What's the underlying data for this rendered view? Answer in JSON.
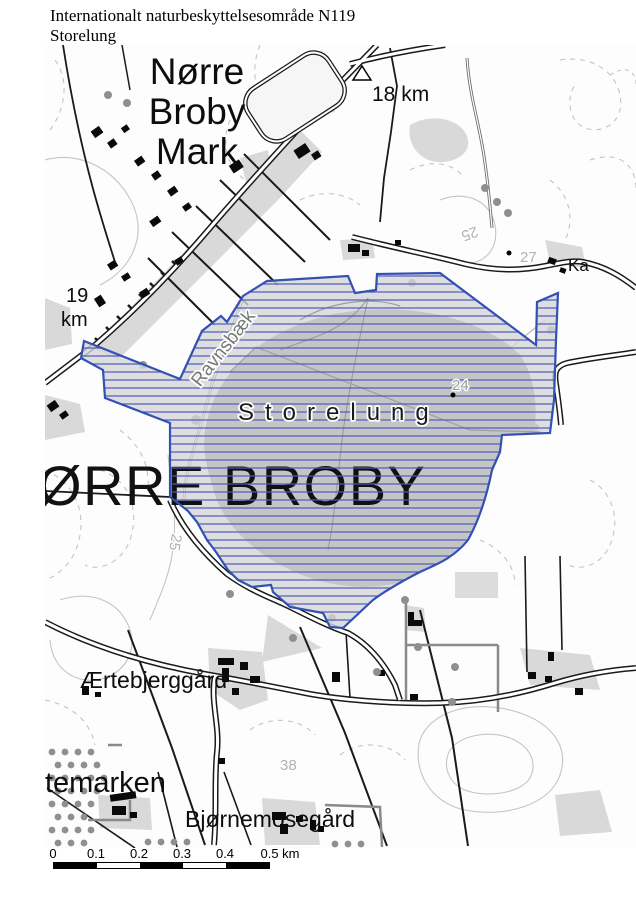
{
  "title": {
    "line1": "Internationalt naturbeskyttelsesområde N119",
    "line2": "Storelung"
  },
  "map": {
    "place_labels": {
      "norre_1": "Nørre",
      "norre_2": "Broby",
      "norre_3": "Mark",
      "town": "ØRRE BROBY",
      "area": "Storelung",
      "stream": "Ravnsbæk",
      "farm_aertebjerggaard": "Ærtebjerggård",
      "farm_bjoernemosegaard": "Bjørnemosegård",
      "field_temarken": "temarken",
      "road_right_clipped": "Ka"
    },
    "distance_labels": {
      "d18": "18 km",
      "d19_line1": "19",
      "d19_line2": "km"
    },
    "contour_labels": {
      "c24": "24",
      "c25_east": "25",
      "c25_west": "25",
      "c27": "27",
      "c38": "38"
    },
    "colors": {
      "protected_area_border": "#3350b5",
      "protected_area_hatch": "#4a5cb0",
      "bog_fill": "#d6d6d8",
      "bog_core": "#c5c5c8",
      "landuse_gray": "#d9d9d9",
      "contour_gray": "#c4c4c4",
      "building_black": "#0a0a0a",
      "dot_gray": "#8f8f8f"
    }
  },
  "scalebar": {
    "ticks": [
      "0",
      "0.1",
      "0.2",
      "0.3",
      "0.4"
    ],
    "end": "0.5 km"
  }
}
